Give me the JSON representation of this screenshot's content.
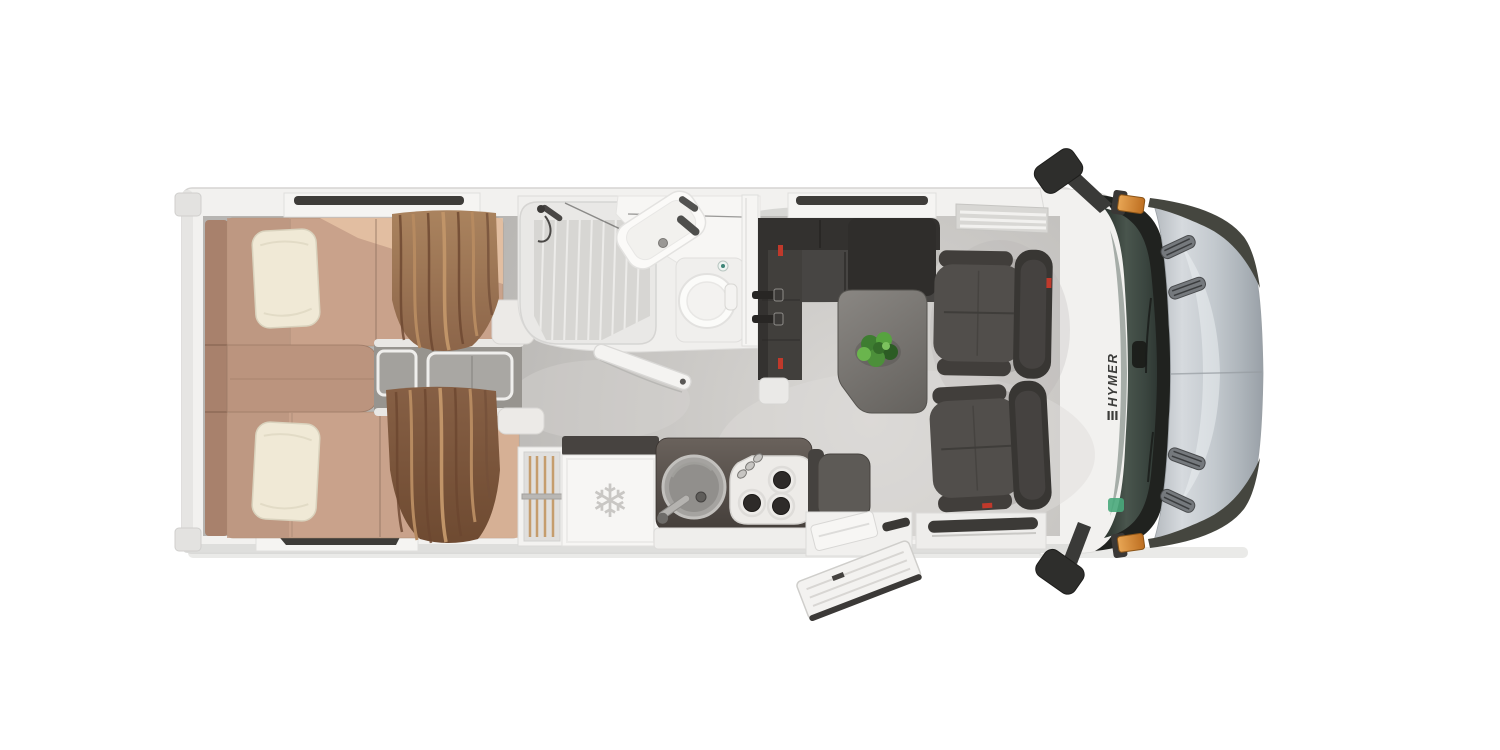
{
  "scene": {
    "description": "Top-down 3D floor plan rendering of a HYMER motorhome",
    "background_color": "#ffffff"
  },
  "cab": {
    "brand_label": "HYMER",
    "windshield_color": "#3a453f",
    "hood_color": "#c3c9ce",
    "marker_color": "#d98a35",
    "mirror_color": "#2e2e2c"
  },
  "bedroom": {
    "items": [
      "twin-bed-top",
      "twin-bed-bottom",
      "middle-cushion",
      "steps",
      "curtains"
    ],
    "mattress_color": "#c9a28b",
    "pillow_color": "#f0e9d6",
    "curtain_color": "#8a6348",
    "headboard_color": "#a8816c"
  },
  "bathroom": {
    "fixtures": [
      "shower",
      "washbasin",
      "toilet",
      "sliding-partition",
      "open-door"
    ],
    "fixture_color": "#f6f5f3"
  },
  "kitchen": {
    "fridge_icon": "❄",
    "appliances": [
      "wardrobe",
      "refrigerator",
      "round-sink",
      "gas-hob-3-burner"
    ],
    "counter_color": "#534c48"
  },
  "lounge": {
    "items": [
      "l-sofa",
      "table",
      "plant",
      "swivel-seat-front",
      "swivel-seat-rear",
      "bench-seat"
    ],
    "sofa_color": "#3e3c3a",
    "table_color": "#75726e",
    "plant_color": "#4a8f3c",
    "belt_anchor_color": "#c0392b"
  },
  "floor": {
    "color": "#c8c6c3"
  }
}
